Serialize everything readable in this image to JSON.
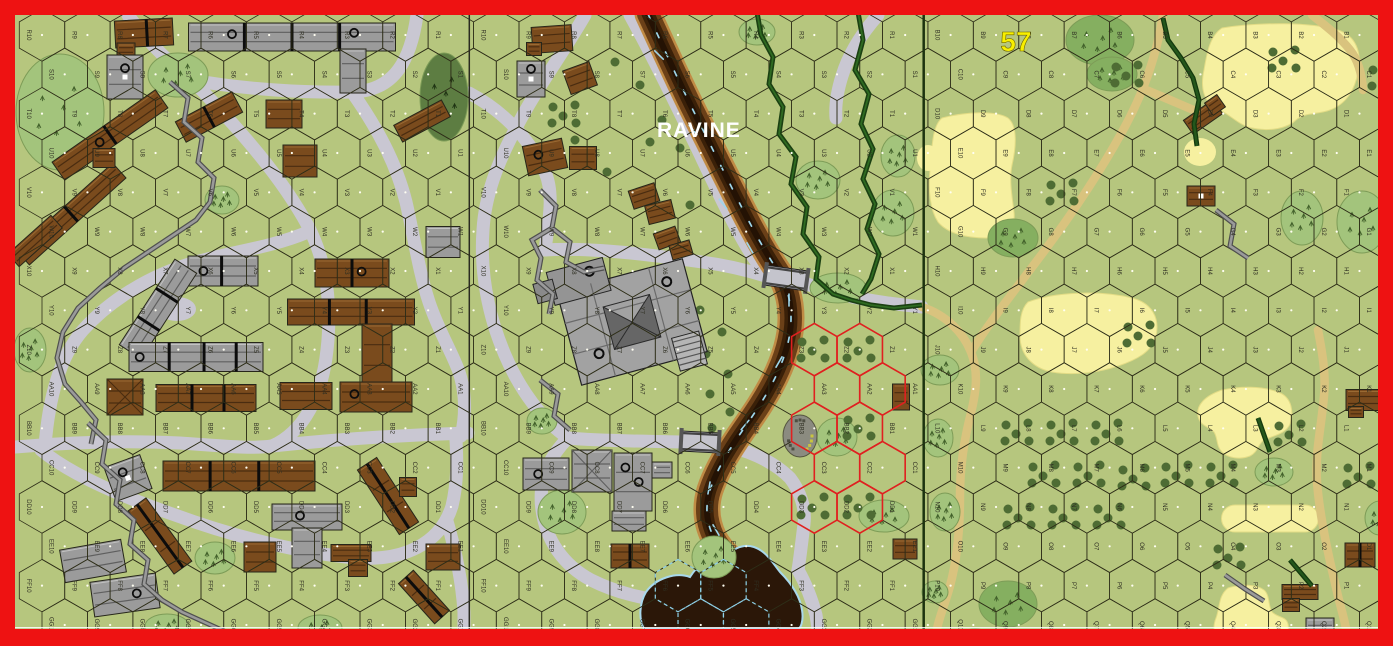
{
  "banners": {
    "board_number": "57",
    "terrain_label": "RAVINE"
  },
  "grid": {
    "x0": 42,
    "y0": 35,
    "col_spacing": 45.43,
    "row_spacing": 39.33,
    "hex_width": 45.43,
    "hex_height": 52.44,
    "boards": [
      {
        "id": "board-left",
        "col_start": 0,
        "rows": [
          "R",
          "S",
          "T",
          "U",
          "V",
          "W",
          "X",
          "Y",
          "Z",
          "AA",
          "BB",
          "CC",
          "DD",
          "EE",
          "FF",
          "GG"
        ],
        "cols": [
          10,
          9,
          8,
          7,
          6,
          5,
          4,
          3,
          2,
          1
        ]
      },
      {
        "id": "board-middle",
        "col_start": 10,
        "rows": [
          "R",
          "S",
          "T",
          "U",
          "V",
          "W",
          "X",
          "Y",
          "Z",
          "AA",
          "BB",
          "CC",
          "DD",
          "EE",
          "FF",
          "GG"
        ],
        "cols": [
          10,
          9,
          8,
          7,
          6,
          5,
          4,
          3,
          2,
          1
        ]
      },
      {
        "id": "board-57",
        "col_start": 20,
        "rows": [
          "B",
          "C",
          "D",
          "E",
          "F",
          "G",
          "H",
          "I",
          "J",
          "K",
          "L",
          "M",
          "N",
          "O",
          "P",
          "Q"
        ],
        "cols": [
          10,
          9,
          8,
          7,
          6,
          5,
          4,
          3,
          2,
          1
        ]
      }
    ]
  },
  "colors": {
    "border": "#ee1212",
    "background": "#b6c67e",
    "hex_line": "#2e2e18",
    "road": "#c9c7d2",
    "dirt_road": "#d9c37e",
    "grain": "#f6f0a0",
    "ravine_bank": "#c08b45",
    "ravine_mid": "#6b4018",
    "ravine_dark": "#3a2008",
    "ravine_core": "#241204",
    "water_line": "#9ed6ea",
    "pond": "#2b1708",
    "woods_line": "#1b4012",
    "brush": "#a3c47c",
    "woods": "#85af60",
    "dark_woods": "#5d7d42",
    "orchard_dot": "#4e6c34",
    "wall": "#9a9a9a",
    "wall_shadow": "#4f4f4f",
    "hedge": "#24571c",
    "building_wood": "#7a4b1d",
    "building_stone": "#9b9b9b",
    "red_zone": "#e02020",
    "hex_label": "#2f2f22",
    "board_number": "#f8ef00",
    "terrain_label_color": "#ffffff"
  }
}
